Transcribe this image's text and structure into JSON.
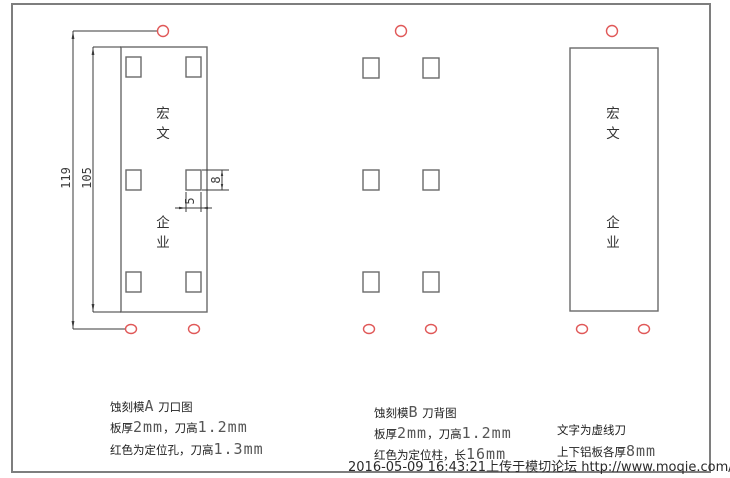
{
  "colors": {
    "line": "#6a6a6a",
    "dim": "#3a3a3a",
    "red": "#e05858",
    "border": "#7e7e7e",
    "text": "#1f1f1f",
    "cad": "#555555",
    "timestamp": "#2a2a2a"
  },
  "dimensions": {
    "total_height": "119",
    "plate_height": "105",
    "slot_height": "8",
    "slot_width": "5"
  },
  "figures": {
    "a": {
      "brand_top": "宏文",
      "brand_bottom": "企业"
    },
    "c": {
      "brand_top": "宏文",
      "brand_bottom": "企业"
    }
  },
  "notes": {
    "a": {
      "line1": [
        {
          "t": "蚀刻模"
        },
        {
          "t": "A"
        },
        {
          "t": " 刀口图"
        }
      ],
      "line2": [
        {
          "t": "板厚"
        },
        {
          "t": "2mm"
        },
        {
          "t": "，刀高"
        },
        {
          "t": "1.2mm"
        }
      ],
      "line3": [
        {
          "t": "红色为定位孔，刀高"
        },
        {
          "t": "1.3mm"
        }
      ]
    },
    "b": {
      "line1": [
        {
          "t": "蚀刻模"
        },
        {
          "t": "B"
        },
        {
          "t": " 刀背图"
        }
      ],
      "line2": [
        {
          "t": "板厚"
        },
        {
          "t": "2mm"
        },
        {
          "t": "，刀高"
        },
        {
          "t": "1.2mm"
        }
      ],
      "line3": [
        {
          "t": "红色为定位柱，长"
        },
        {
          "t": "16mm"
        }
      ]
    },
    "c": {
      "line1": [
        {
          "t": "文字为虚线刀"
        }
      ],
      "line2": [
        {
          "t": "上下铝板各厚"
        },
        {
          "t": "8mm"
        }
      ]
    }
  },
  "footer": {
    "timestamp": "2016-05-09 16:43:21上传于模切论坛 http://www.moqie.com/bbs/"
  }
}
